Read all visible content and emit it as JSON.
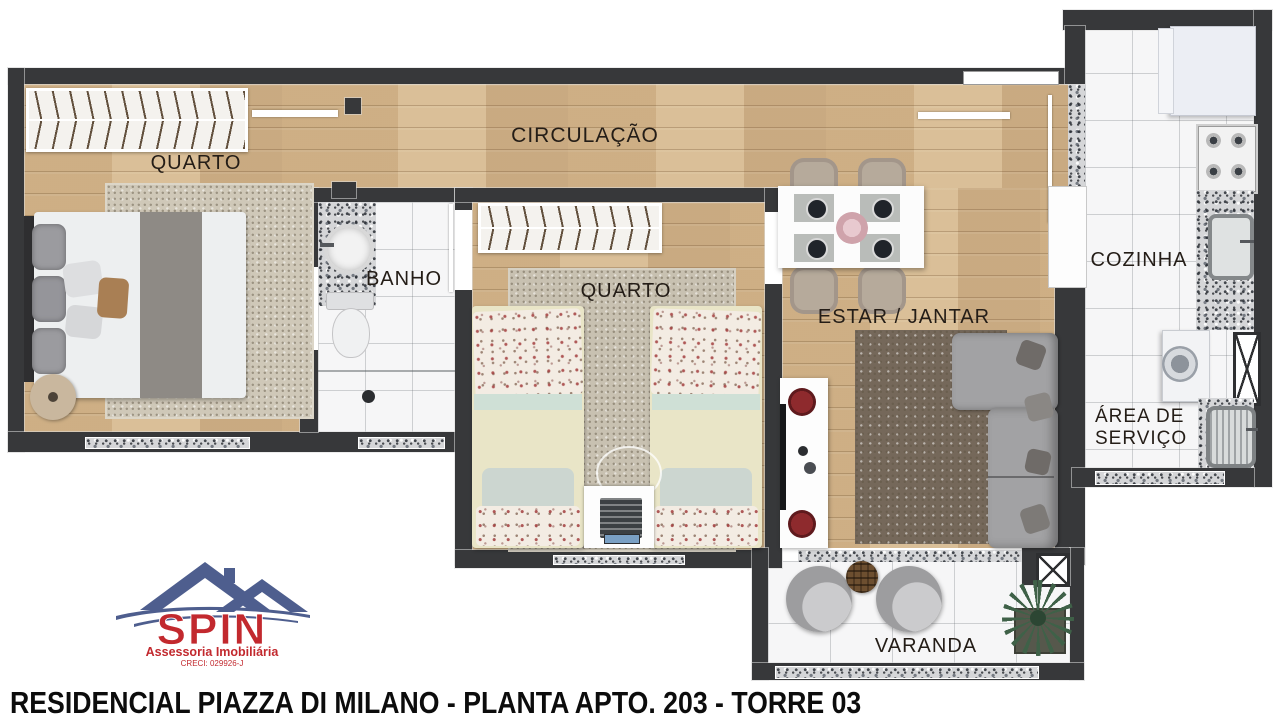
{
  "rooms": {
    "bedroom1": "QUARTO",
    "hallway": "CIRCULAÇÃO",
    "bathroom": "BANHO",
    "bedroom2": "QUARTO",
    "living": "ESTAR / JANTAR",
    "kitchen": "COZINHA",
    "service": "ÁREA DE SERVIÇO",
    "balcony": "VARANDA"
  },
  "logo": {
    "brand": "SPIN",
    "tagline": "Assessoria Imobiliária",
    "creci": "CRECI: 029926-J"
  },
  "footer": {
    "title": "RESIDENCIAL PIAZZA DI MILANO - PLANTA APTO. 203 - TORRE 03"
  },
  "colors": {
    "wall": "#37383a",
    "wood_floor": "#d5b88f",
    "tile_floor": "#f6f6f7",
    "granite": "#d5d6d8",
    "living_rug": "#75685a",
    "bedroom_rug": "#cfc8b8",
    "sofa": "#a2a2a4",
    "dining_chair": "#b6aa9b",
    "bed_blanket": "#e9e5c7",
    "label_text": "#241d17",
    "logo_red": "#c2292e",
    "logo_blue": "#4e5e8e",
    "title_text": "#0c0c0c"
  }
}
